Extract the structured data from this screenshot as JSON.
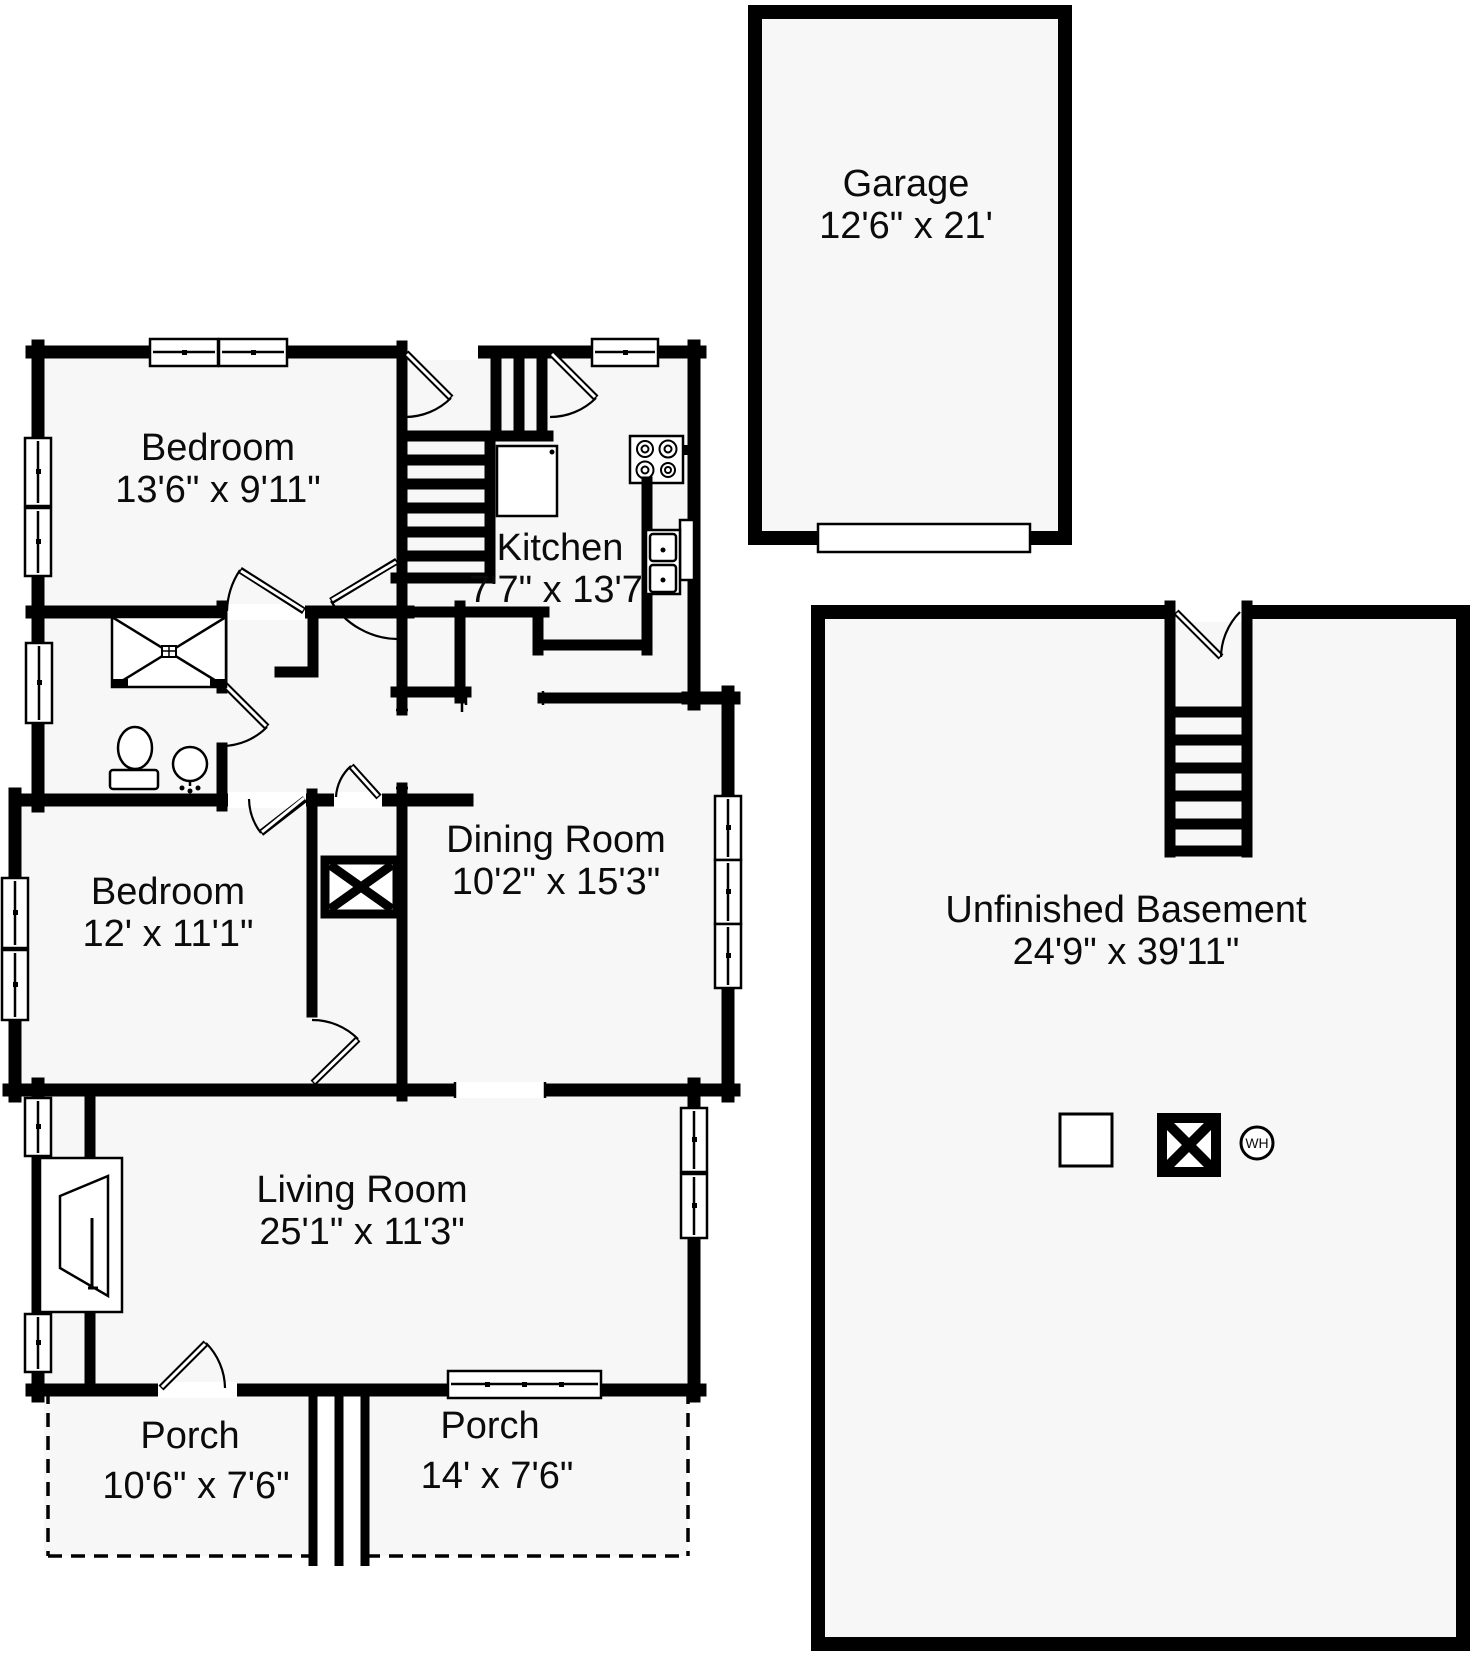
{
  "plan_title": "House floor plan with basement and garage",
  "colors": {
    "wall": "#000000",
    "room_fill": "#f7f7f7",
    "background": "#ffffff"
  },
  "rooms": {
    "garage": {
      "name": "Garage",
      "dims": "12'6\" x 21'"
    },
    "bedroom1": {
      "name": "Bedroom",
      "dims": "13'6\" x 9'11\""
    },
    "kitchen": {
      "name": "Kitchen",
      "dims": "7'7\" x 13'7"
    },
    "dining": {
      "name": "Dining Room",
      "dims": "10'2\" x 15'3\""
    },
    "bedroom2": {
      "name": "Bedroom",
      "dims": "12' x 11'1\""
    },
    "living": {
      "name": "Living Room",
      "dims": "25'1\" x 11'3\""
    },
    "basement": {
      "name": "Unfinished Basement",
      "dims": "24'9\" x 39'11\""
    },
    "porch_left": {
      "name": "Porch",
      "dims": "10'6\" x 7'6\""
    },
    "porch_right": {
      "name": "Porch",
      "dims": "14' x 7'6\""
    }
  },
  "symbols": {
    "water_heater": "WH"
  }
}
